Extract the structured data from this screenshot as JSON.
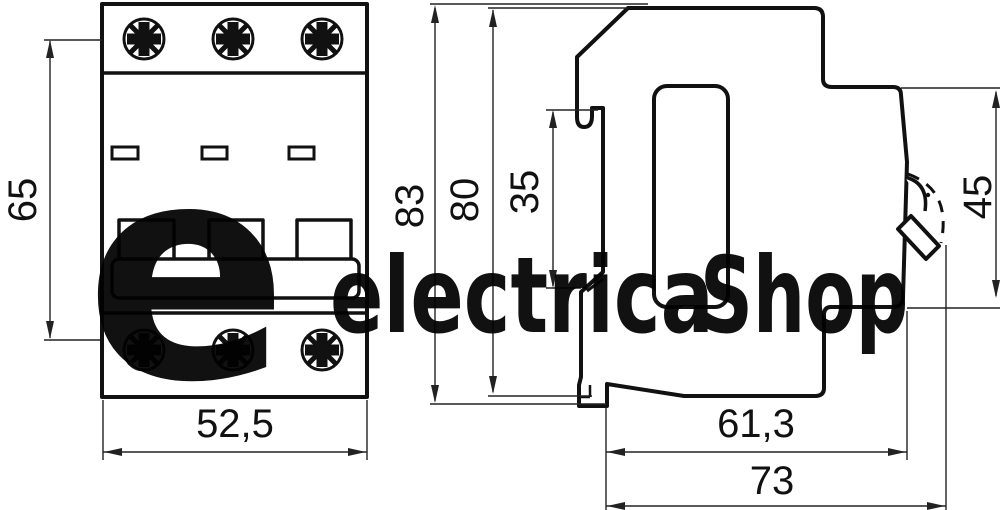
{
  "drawing": {
    "type": "circuit-breaker dimensional drawing, front view and side view"
  },
  "dims": {
    "front_height": "65",
    "front_width": "52,5",
    "side_overall_height": "83",
    "side_body_height": "80",
    "side_din_slot_height": "35",
    "side_front_height": "45",
    "side_body_depth": "61,3",
    "side_overall_depth": "73"
  },
  "watermark": {
    "mark": "e",
    "name": "electrica",
    "suffix": "Shop",
    "blue": "#b5dff2",
    "gray": "#c5c5c7"
  },
  "colors": {
    "line": "#111111",
    "dimension_line": "#222222",
    "background": "#ffffff"
  }
}
